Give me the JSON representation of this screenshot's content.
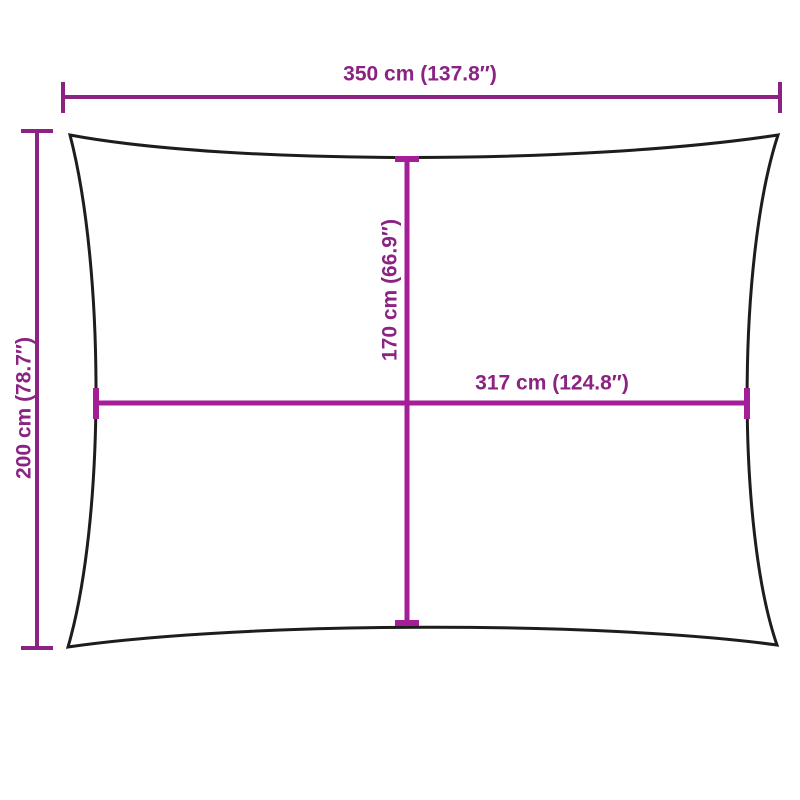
{
  "diagram": {
    "type": "product-dimension-diagram",
    "subject": "rectangular shade sail with concave edges",
    "colors": {
      "background": "#ffffff",
      "outline": "#1d1d1b",
      "outer_dimension": "#8b2383",
      "inner_dimension": "#a41e98",
      "label_text": "#8b2383"
    },
    "dimensions": {
      "width_top": {
        "label": "350 cm (137.8″)",
        "value_cm": 350,
        "value_in": 137.8,
        "orientation": "horizontal",
        "position": "top edge-to-edge width"
      },
      "height_left": {
        "label": "200 cm (78.7″)",
        "value_cm": 200,
        "value_in": 78.7,
        "orientation": "vertical",
        "position": "left edge-to-edge height"
      },
      "height_center": {
        "label": "170 cm (66.9″)",
        "value_cm": 170,
        "value_in": 66.9,
        "orientation": "vertical",
        "position": "center height between concave edges"
      },
      "width_center": {
        "label": "317 cm (124.8″)",
        "value_cm": 317,
        "value_in": 124.8,
        "orientation": "horizontal",
        "position": "center width between concave edges"
      }
    }
  }
}
